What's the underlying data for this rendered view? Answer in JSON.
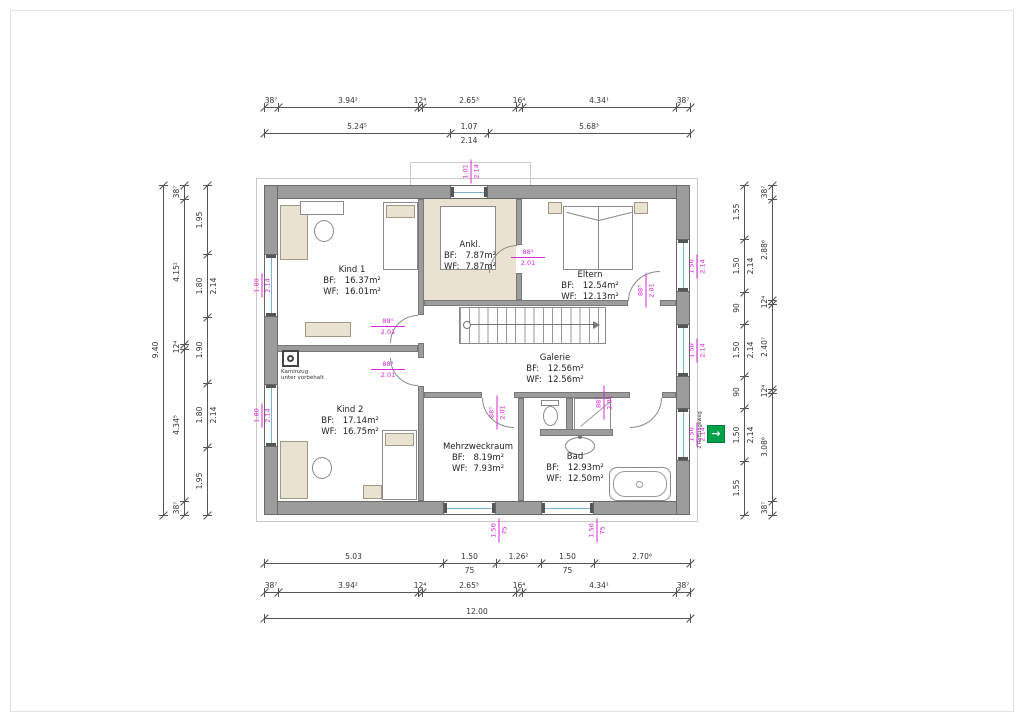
{
  "drawing_type": "floor-plan",
  "colors": {
    "wall": "#9c9c9c",
    "furniture": "#e9e2d0",
    "glass": "#7ab2d4",
    "tag_magenta": "#d926d9",
    "escape_green": "#00A14B"
  },
  "rooms": [
    {
      "id": "kind1",
      "name": "Kind 1",
      "bf": "16.37m²",
      "wf": "16.01m²"
    },
    {
      "id": "ankl",
      "name": "Ankl.",
      "bf": "7.87m²",
      "wf": "7.87m²"
    },
    {
      "id": "eltern",
      "name": "Eltern",
      "bf": "12.54m²",
      "wf": "12.13m²"
    },
    {
      "id": "galerie",
      "name": "Galerie",
      "bf": "12.56m²",
      "wf": "12.56m²"
    },
    {
      "id": "kind2",
      "name": "Kind 2",
      "bf": "17.14m²",
      "wf": "16.75m²"
    },
    {
      "id": "mehrzweckraum",
      "name": "Mehrzweckraum",
      "bf": "8.19m²",
      "wf": "7.93m²"
    },
    {
      "id": "bad",
      "name": "Bad",
      "bf": "12.93m²",
      "wf": "12.50m²"
    }
  ],
  "labels": {
    "bf": "BF:",
    "wf": "WF:",
    "kaminzug_line1": "Kaminzug",
    "kaminzug_line2": "unter vorbehalt",
    "ohne_roll": "ohne Roll.",
    "rettungsweg": "2 Rettungsweg",
    "escape_arrow": "→"
  },
  "dimensions": {
    "top_row1": [
      {
        "v": "38⁷"
      },
      {
        "v": "3.94²"
      },
      {
        "v": "12⁴"
      },
      {
        "v": "2.65³"
      },
      {
        "v": "16⁴"
      },
      {
        "v": "4.34¹"
      },
      {
        "v": "38⁷"
      }
    ],
    "top_row2": [
      {
        "v": "5.24⁵"
      },
      {
        "v": "1.07",
        "sub": "2.14"
      },
      {
        "v": "5.68³"
      }
    ],
    "bottom_row1": [
      {
        "v": "5.03"
      },
      {
        "v": "1.50",
        "sub": "75"
      },
      {
        "v": "1.26²"
      },
      {
        "v": "1.50",
        "sub": "75"
      },
      {
        "v": "2.70⁸"
      }
    ],
    "bottom_row2": [
      {
        "v": "38⁷"
      },
      {
        "v": "3.94²"
      },
      {
        "v": "12⁴"
      },
      {
        "v": "2.65³"
      },
      {
        "v": "16⁴"
      },
      {
        "v": "4.34¹"
      },
      {
        "v": "38⁷"
      }
    ],
    "bottom_total": [
      {
        "v": "12.00"
      }
    ],
    "left_outer": [
      {
        "v": "9.40"
      }
    ],
    "left_mid": [
      {
        "v": "38⁷"
      },
      {
        "v": "4.15²"
      },
      {
        "v": "12⁴"
      },
      {
        "v": "4.34⁵"
      },
      {
        "v": "38⁷"
      }
    ],
    "left_inner": [
      {
        "v": "1.95"
      },
      {
        "v": "1.80",
        "sub": "2.14"
      },
      {
        "v": "1.90"
      },
      {
        "v": "1.80",
        "sub": "2.14"
      },
      {
        "v": "1.95"
      }
    ],
    "right_inner": [
      {
        "v": "1.55"
      },
      {
        "v": "1.50",
        "sub": "2.14"
      },
      {
        "v": "90"
      },
      {
        "v": "1.50",
        "sub": "2.14"
      },
      {
        "v": "90"
      },
      {
        "v": "1.50",
        "sub": "2.14"
      },
      {
        "v": "1.55"
      }
    ],
    "right_outer": [
      {
        "v": "38⁷"
      },
      {
        "v": "2.88⁶"
      },
      {
        "v": "12⁴"
      },
      {
        "v": "2.40⁷"
      },
      {
        "v": "12⁴"
      },
      {
        "v": "3.08⁶"
      },
      {
        "v": "38⁷"
      }
    ]
  },
  "tags": {
    "door": {
      "w": "88⁵",
      "h": "2.01"
    },
    "window_left": {
      "w": "1.80",
      "h": "2.14"
    },
    "window_top": {
      "w": "1.01",
      "h": "2.14"
    },
    "window_right": {
      "w": "1.50",
      "h": "2.14"
    },
    "window_bottom": {
      "w": "1.50",
      "h": "75"
    }
  }
}
